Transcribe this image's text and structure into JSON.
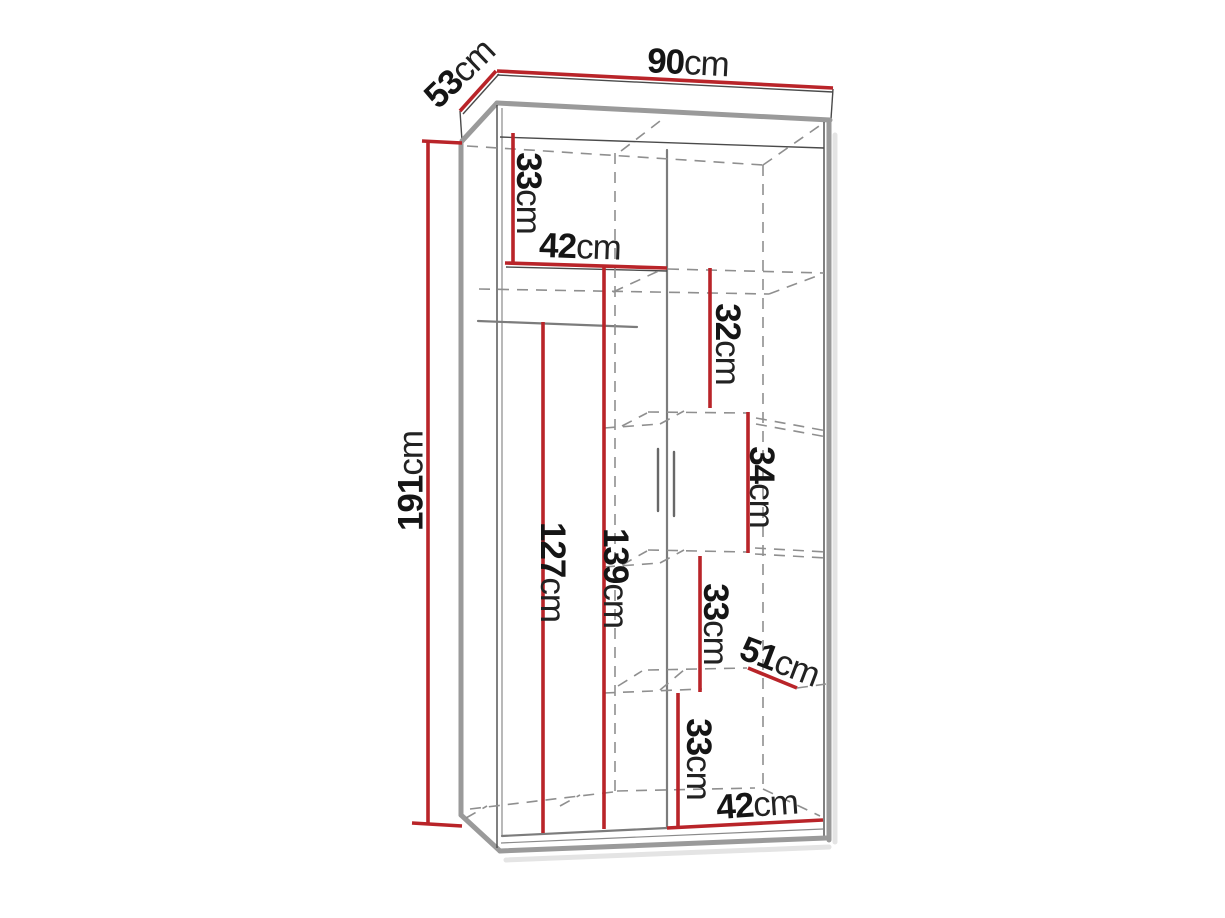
{
  "figure": {
    "type": "furniture dimension diagram",
    "subject": "two-door wardrobe with interior shelves and hanging rail",
    "view": "three-quarter front technical sketch",
    "unit": "cm"
  },
  "colors": {
    "background": "#ffffff",
    "dimension_line": "#b92429",
    "label_text": "#151515",
    "outline": "#9a9a9a",
    "hidden_edge": "#8f8f8f"
  },
  "dims": {
    "overall_width": {
      "value": "90",
      "unit": "cm"
    },
    "overall_depth": {
      "value": "53",
      "unit": "cm"
    },
    "overall_height": {
      "value": "191",
      "unit": "cm"
    },
    "left_top_section_height": {
      "value": "33",
      "unit": "cm"
    },
    "left_shelf_width": {
      "value": "42",
      "unit": "cm"
    },
    "right_section1_height": {
      "value": "32",
      "unit": "cm"
    },
    "right_section2_height": {
      "value": "34",
      "unit": "cm"
    },
    "left_section_height": {
      "value": "139",
      "unit": "cm"
    },
    "hanging_section_height": {
      "value": "127",
      "unit": "cm"
    },
    "right_section3_height": {
      "value": "33",
      "unit": "cm"
    },
    "shelf_depth": {
      "value": "51",
      "unit": "cm"
    },
    "right_section4_height": {
      "value": "33",
      "unit": "cm"
    },
    "right_shelf_width": {
      "value": "42",
      "unit": "cm"
    }
  }
}
